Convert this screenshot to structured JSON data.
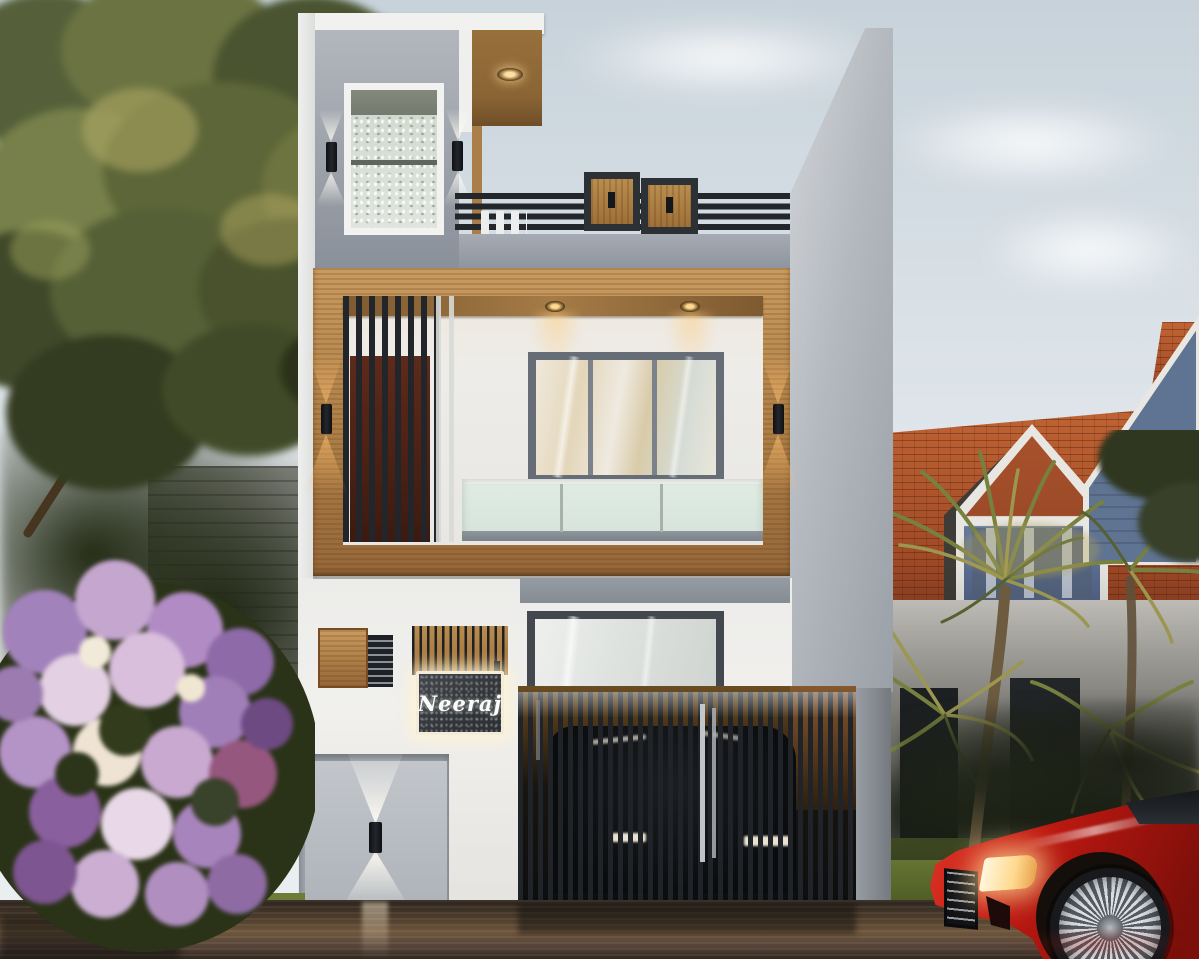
{
  "scene": {
    "title": "Modern two-storey duplex house - dusk exterior 3D render",
    "nameplate": {
      "text": "Neeraj"
    },
    "palette": {
      "sky_top": "#c7d2da",
      "sky_bottom": "#eceff0",
      "facade_white": "#efeeec",
      "facade_grey": "#9aa0a9",
      "wood_accent": "#b5854a",
      "wood_soffit": "#8a6434",
      "slat_black": "#22262a",
      "window_frame_grey": "#666d76",
      "window_reflection_warm": "#e3d6ba",
      "balcony_frosted_glass": "#dfece3",
      "warm_lamp_glow": "#ffd98f",
      "cool_lamp_glow": "#fffcf4",
      "nameplate_bg": "#33373a",
      "nameplate_border": "#f3ecd9",
      "nameplate_text_color": "#fcfcfa",
      "door_wood_dark": "#5e2a1a",
      "lawn_green": "#71813a",
      "wet_road_bronze": "#6e563d",
      "neighbor_roof_orange": "#b4572f",
      "neighbor_gable_blue": "#5f7392",
      "flower_purple": "#a683bd",
      "flower_pink": "#e3d0e2",
      "flower_white": "#efe3d4",
      "palm_olive": "#77813f",
      "tree_gold": "#b3ab66",
      "car_red": "#c21a12",
      "headlight": "#ffd98f"
    },
    "objects": [
      "sky",
      "left-tree",
      "neighbor-roof-left",
      "stone-wall",
      "flower-bush",
      "main-house",
      "rooftop-railing",
      "railing-wood-panels",
      "tower-window",
      "wall-sconces",
      "wood-accent-frame",
      "first-floor-window",
      "balcony-glass-railing",
      "vertical-slat-screen",
      "recessed-downlights",
      "nameplate",
      "ground-floor-glass-door",
      "wood-wall-panels",
      "louver-vent",
      "garage-door",
      "garage-wall-lamp",
      "driveway-gate",
      "car-behind-gate",
      "right-side-wall",
      "boundary-pillar",
      "neighbor-roof-right",
      "neighbor-dormer",
      "neighbor-gable",
      "palm-trees",
      "lawn",
      "wet-road",
      "red-sports-car"
    ]
  }
}
